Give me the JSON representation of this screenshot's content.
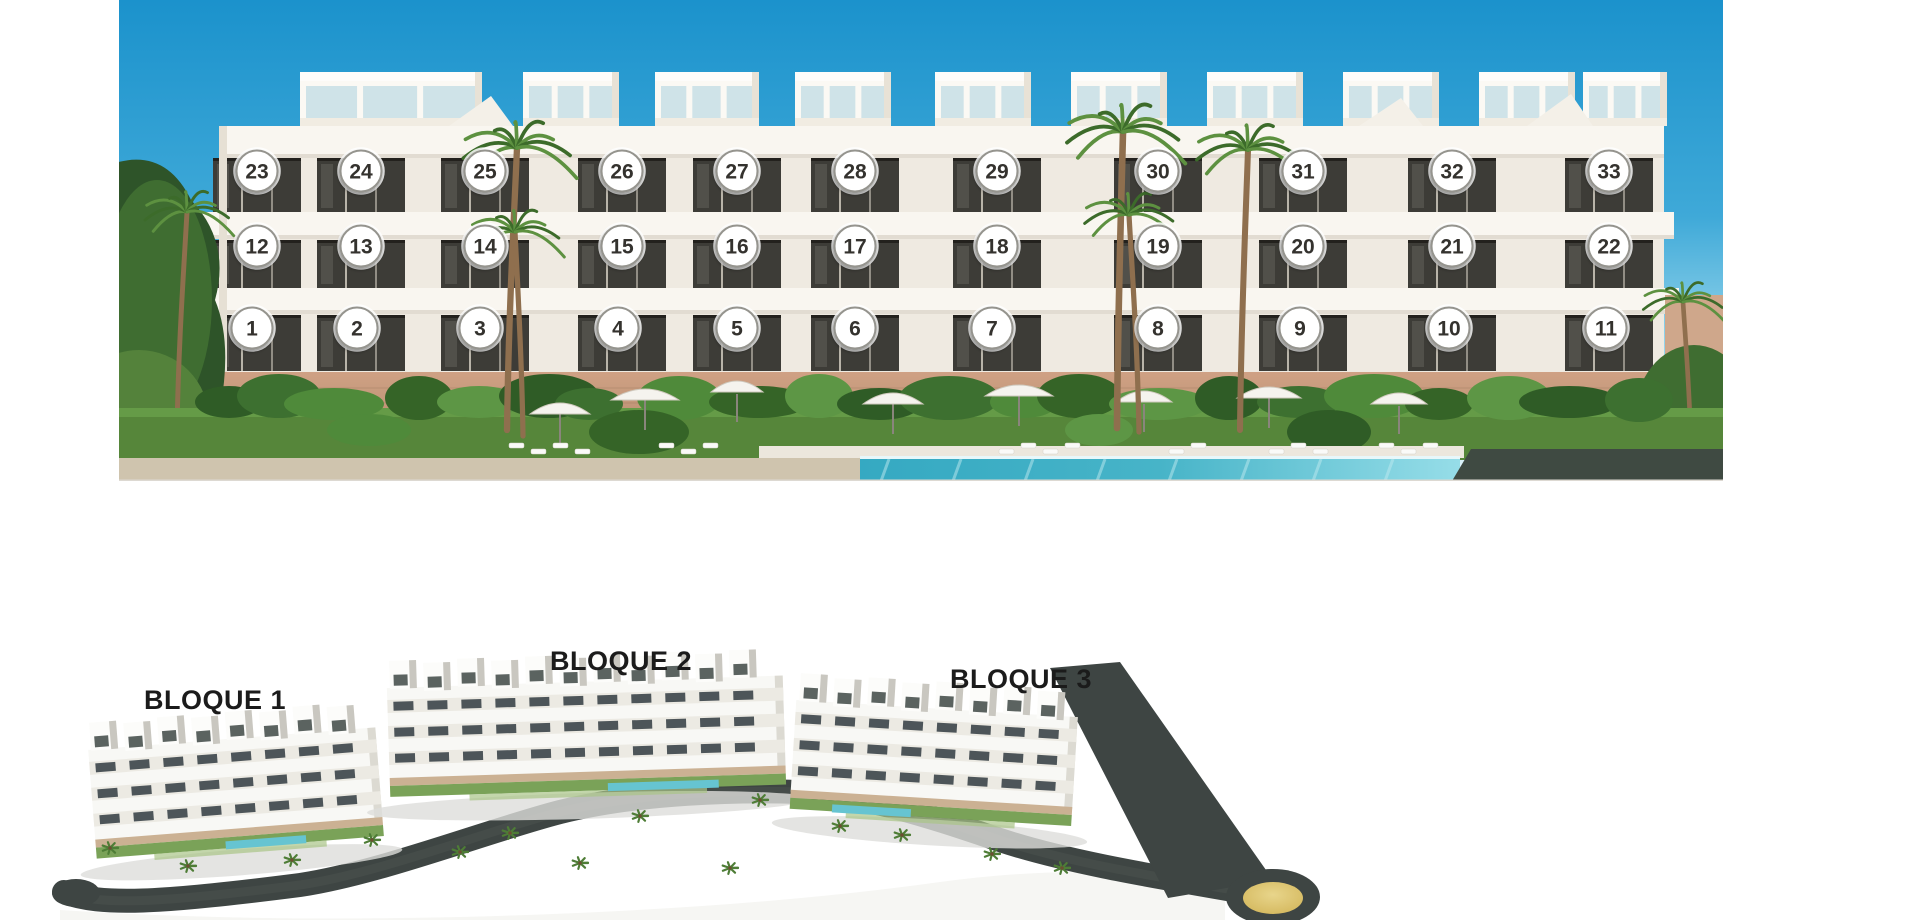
{
  "page": {
    "background": "#ffffff"
  },
  "facade_panel": {
    "caption": "numbered-front-elevation",
    "marker": {
      "fill": "#ffffff",
      "ring": "#95948e",
      "halo": "#ffffff",
      "text_color": "#34322e",
      "radius": 20.5,
      "font_size": 21
    },
    "unit_rows": [
      {
        "floor": "top-floor",
        "y": 171,
        "xs": [
          138,
          242,
          366,
          503,
          618,
          736,
          878,
          1039,
          1184,
          1333,
          1490
        ],
        "units": [
          "23",
          "24",
          "25",
          "26",
          "27",
          "28",
          "29",
          "30",
          "31",
          "32",
          "33"
        ]
      },
      {
        "floor": "middle-floor",
        "y": 246,
        "xs": [
          138,
          242,
          366,
          503,
          618,
          736,
          878,
          1039,
          1184,
          1333,
          1490
        ],
        "units": [
          "12",
          "13",
          "14",
          "15",
          "16",
          "17",
          "18",
          "19",
          "20",
          "21",
          "22"
        ]
      },
      {
        "floor": "ground-floor",
        "y": 328,
        "xs": [
          133,
          238,
          361,
          499,
          618,
          736,
          873,
          1039,
          1181,
          1330,
          1487
        ],
        "units": [
          "1",
          "2",
          "3",
          "4",
          "5",
          "6",
          "7",
          "8",
          "9",
          "10",
          "11"
        ]
      }
    ]
  },
  "site_panel": {
    "caption": "three-block-siteplan",
    "label_color": "#1b1b1b",
    "label_font_size": 27,
    "block_labels": [
      {
        "text": "BLOQUE 1",
        "x": 175,
        "y": 79
      },
      {
        "text": "BLOQUE 2",
        "x": 581,
        "y": 40
      },
      {
        "text": "BLOQUE 3",
        "x": 981,
        "y": 58
      }
    ]
  },
  "palette": {
    "sky_top": "#1b92cc",
    "sky_mid": "#3fa9d8",
    "sky_horizon": "#c6ebf6",
    "building_white": "#f7f4ed",
    "band_white": "#f9f6f0",
    "window_glass": "#3d3c37",
    "base_stone": "#c89d80",
    "lawn_green": "#56863a",
    "palm_green_dark": "#3c6b2a",
    "palm_green_light": "#5d9140",
    "pool_teal": "#47b4c8",
    "pool_light": "#96dde8",
    "dark_hedge_panel": "#3f4a42",
    "road_asphalt": "#3e4543",
    "roundabout_gold": "#d8bc62"
  }
}
